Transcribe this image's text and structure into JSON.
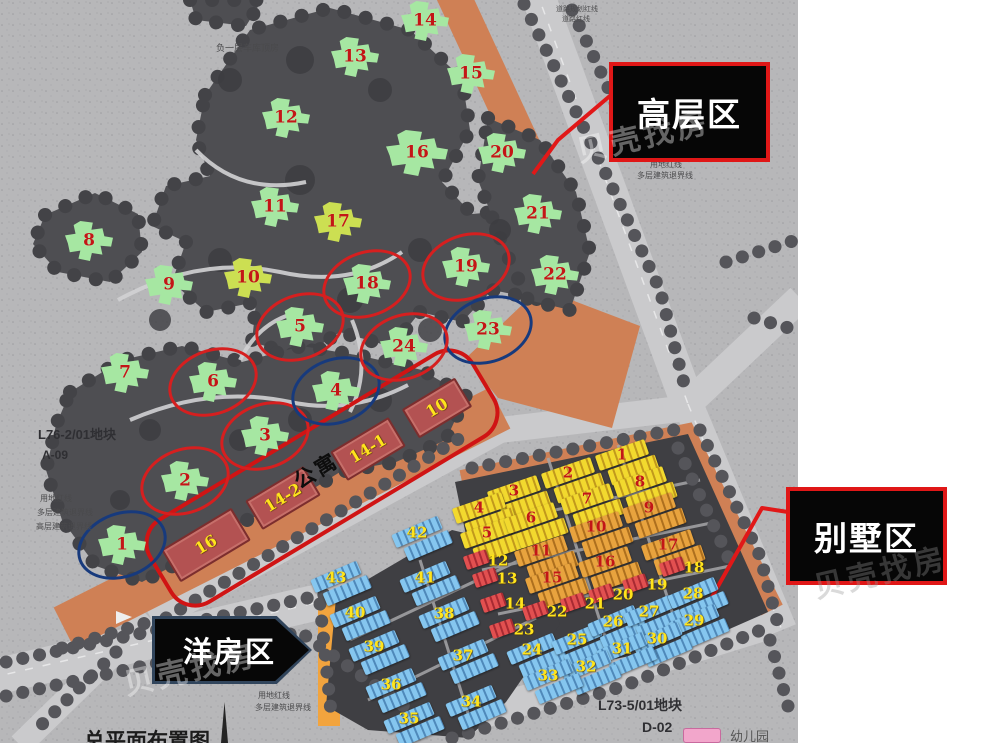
{
  "zones": {
    "highrise_label": "高层区",
    "villa_label": "别墅区",
    "garden_label": "洋房区"
  },
  "apartment": {
    "label": "公寓",
    "blocks": [
      {
        "label": "16",
        "x": 206,
        "y": 545,
        "w": 78,
        "h": 34
      },
      {
        "label": "14-2",
        "x": 283,
        "y": 498,
        "w": 64,
        "h": 30
      },
      {
        "label": "14-1",
        "x": 368,
        "y": 449,
        "w": 64,
        "h": 30
      },
      {
        "label": "10",
        "x": 437,
        "y": 408,
        "w": 58,
        "h": 30
      }
    ]
  },
  "highrise_buildings": [
    {
      "n": "1",
      "x": 122,
      "y": 545,
      "kind": "green",
      "ring": "blue"
    },
    {
      "n": "2",
      "x": 185,
      "y": 481,
      "kind": "green",
      "ring": "red"
    },
    {
      "n": "3",
      "x": 265,
      "y": 436,
      "kind": "green",
      "ring": "red"
    },
    {
      "n": "4",
      "x": 336,
      "y": 391,
      "kind": "green",
      "ring": "blue"
    },
    {
      "n": "5",
      "x": 300,
      "y": 327,
      "kind": "green",
      "ring": "red"
    },
    {
      "n": "6",
      "x": 213,
      "y": 382,
      "kind": "green",
      "ring": "red"
    },
    {
      "n": "7",
      "x": 125,
      "y": 373,
      "kind": "green",
      "ring": null
    },
    {
      "n": "8",
      "x": 89,
      "y": 241,
      "kind": "green",
      "ring": null
    },
    {
      "n": "9",
      "x": 169,
      "y": 285,
      "kind": "green",
      "ring": null
    },
    {
      "n": "10",
      "x": 248,
      "y": 278,
      "kind": "lime",
      "ring": null
    },
    {
      "n": "11",
      "x": 275,
      "y": 207,
      "kind": "green",
      "ring": null
    },
    {
      "n": "12",
      "x": 286,
      "y": 118,
      "kind": "green",
      "ring": null
    },
    {
      "n": "13",
      "x": 355,
      "y": 57,
      "kind": "green",
      "ring": null
    },
    {
      "n": "14",
      "x": 425,
      "y": 21,
      "kind": "green",
      "ring": null
    },
    {
      "n": "15",
      "x": 471,
      "y": 74,
      "kind": "green",
      "ring": null
    },
    {
      "n": "16",
      "x": 417,
      "y": 153,
      "kind": "green",
      "ring": null,
      "big": true
    },
    {
      "n": "17",
      "x": 338,
      "y": 222,
      "kind": "lime",
      "ring": null
    },
    {
      "n": "18",
      "x": 367,
      "y": 284,
      "kind": "green",
      "ring": "red"
    },
    {
      "n": "19",
      "x": 466,
      "y": 267,
      "kind": "green",
      "ring": "red"
    },
    {
      "n": "20",
      "x": 502,
      "y": 153,
      "kind": "green",
      "ring": null
    },
    {
      "n": "21",
      "x": 538,
      "y": 214,
      "kind": "green",
      "ring": null
    },
    {
      "n": "22",
      "x": 555,
      "y": 275,
      "kind": "green",
      "ring": null
    },
    {
      "n": "23",
      "x": 488,
      "y": 330,
      "kind": "green",
      "ring": "blue"
    },
    {
      "n": "24",
      "x": 404,
      "y": 347,
      "kind": "green",
      "ring": "red"
    }
  ],
  "villa_buildings": [
    {
      "n": "1",
      "x": 622,
      "y": 455,
      "kind": "yellow"
    },
    {
      "n": "2",
      "x": 568,
      "y": 473,
      "kind": "yellow"
    },
    {
      "n": "3",
      "x": 514,
      "y": 491,
      "kind": "yellow"
    },
    {
      "n": "4",
      "x": 479,
      "y": 508,
      "kind": "yellow"
    },
    {
      "n": "5",
      "x": 487,
      "y": 533,
      "kind": "yellow"
    },
    {
      "n": "6",
      "x": 531,
      "y": 518,
      "kind": "yellow"
    },
    {
      "n": "7",
      "x": 587,
      "y": 499,
      "kind": "yellow"
    },
    {
      "n": "8",
      "x": 640,
      "y": 482,
      "kind": "yellow"
    },
    {
      "n": "9",
      "x": 649,
      "y": 508,
      "kind": "orange"
    },
    {
      "n": "10",
      "x": 596,
      "y": 527,
      "kind": "orange"
    },
    {
      "n": "11",
      "x": 541,
      "y": 551,
      "kind": "orange"
    },
    {
      "n": "15",
      "x": 552,
      "y": 578,
      "kind": "orange"
    },
    {
      "n": "16",
      "x": 605,
      "y": 562,
      "kind": "orange"
    },
    {
      "n": "17",
      "x": 668,
      "y": 545,
      "kind": "orange"
    },
    {
      "n": "12",
      "x": 498,
      "y": 561,
      "kind": "redsm"
    },
    {
      "n": "13",
      "x": 507,
      "y": 579,
      "kind": "redsm"
    },
    {
      "n": "14",
      "x": 515,
      "y": 604,
      "kind": "redsm"
    },
    {
      "n": "18",
      "x": 694,
      "y": 568,
      "kind": "redsm"
    },
    {
      "n": "19",
      "x": 657,
      "y": 585,
      "kind": "redsm"
    },
    {
      "n": "20",
      "x": 623,
      "y": 595,
      "kind": "redsm"
    },
    {
      "n": "21",
      "x": 595,
      "y": 604,
      "kind": "redsm"
    },
    {
      "n": "22",
      "x": 557,
      "y": 612,
      "kind": "redsm"
    },
    {
      "n": "23",
      "x": 524,
      "y": 630,
      "kind": "redsm"
    },
    {
      "n": "24",
      "x": 532,
      "y": 650,
      "kind": "blue"
    },
    {
      "n": "25",
      "x": 577,
      "y": 640,
      "kind": "blue"
    },
    {
      "n": "26",
      "x": 613,
      "y": 622,
      "kind": "blue"
    },
    {
      "n": "27",
      "x": 649,
      "y": 612,
      "kind": "blue"
    },
    {
      "n": "28",
      "x": 693,
      "y": 594,
      "kind": "blue"
    },
    {
      "n": "29",
      "x": 694,
      "y": 621,
      "kind": "blue"
    },
    {
      "n": "30",
      "x": 657,
      "y": 639,
      "kind": "blue"
    },
    {
      "n": "31",
      "x": 622,
      "y": 649,
      "kind": "blue"
    },
    {
      "n": "32",
      "x": 586,
      "y": 667,
      "kind": "blue"
    },
    {
      "n": "33",
      "x": 548,
      "y": 676,
      "kind": "blue"
    },
    {
      "n": "34",
      "x": 471,
      "y": 702,
      "kind": "blue"
    },
    {
      "n": "35",
      "x": 409,
      "y": 719,
      "kind": "blue"
    },
    {
      "n": "36",
      "x": 391,
      "y": 685,
      "kind": "blue"
    },
    {
      "n": "37",
      "x": 463,
      "y": 656,
      "kind": "blue"
    },
    {
      "n": "38",
      "x": 444,
      "y": 614,
      "kind": "blue"
    },
    {
      "n": "39",
      "x": 374,
      "y": 647,
      "kind": "blue"
    },
    {
      "n": "40",
      "x": 355,
      "y": 613,
      "kind": "blue"
    },
    {
      "n": "41",
      "x": 425,
      "y": 578,
      "kind": "blue"
    },
    {
      "n": "42",
      "x": 417,
      "y": 533,
      "kind": "blue"
    },
    {
      "n": "43",
      "x": 336,
      "y": 578,
      "kind": "blue"
    }
  ],
  "map_texts": [
    {
      "text": "负一层车库顶房",
      "x": 216,
      "y": 44,
      "size": 9
    },
    {
      "text": "道路规划红线",
      "x": 556,
      "y": 6,
      "size": 7
    },
    {
      "text": "道路红线",
      "x": 562,
      "y": 16,
      "size": 7
    },
    {
      "text": "用地红线",
      "x": 650,
      "y": 161,
      "size": 8
    },
    {
      "text": "多层建筑退界线",
      "x": 637,
      "y": 172,
      "size": 8
    },
    {
      "text": "L76-2/01地块",
      "x": 38,
      "y": 428,
      "size": 13,
      "bold": true,
      "color": "#2f2f33"
    },
    {
      "text": "A-09",
      "x": 42,
      "y": 449,
      "size": 12,
      "bold": true,
      "color": "#2f2f33"
    },
    {
      "text": "用地红线",
      "x": 40,
      "y": 495,
      "size": 8
    },
    {
      "text": "多层建筑退界线",
      "x": 37,
      "y": 509,
      "size": 8
    },
    {
      "text": "高层建筑退界线",
      "x": 36,
      "y": 523,
      "size": 8
    },
    {
      "text": "用地红线",
      "x": 258,
      "y": 692,
      "size": 8
    },
    {
      "text": "多层建筑退界线",
      "x": 255,
      "y": 704,
      "size": 8
    },
    {
      "text": "L73-5/01地块",
      "x": 598,
      "y": 698,
      "size": 14,
      "bold": true,
      "color": "#2f2f33"
    },
    {
      "text": "D-02",
      "x": 642,
      "y": 720,
      "size": 14,
      "bold": true,
      "color": "#2f2f33"
    },
    {
      "text": "总平面布置图",
      "x": 84,
      "y": 730,
      "size": 21,
      "bold": true,
      "color": "#1c1c1c"
    }
  ],
  "legend": {
    "items": [
      {
        "label": "幼儿园",
        "color": "#f2a6cb"
      }
    ]
  },
  "watermark": {
    "text": "贝壳找房",
    "instances": [
      {
        "x": 575,
        "y": 112,
        "on_dark": true
      },
      {
        "x": 122,
        "y": 645,
        "on_dark": true
      },
      {
        "x": 812,
        "y": 548,
        "on_dark": false
      }
    ]
  },
  "colors": {
    "ring_red": "#d61f1f",
    "ring_blue": "#173a7d",
    "highrise_green": "#a6e7a2",
    "highrise_lime": "#ccdf52",
    "villa_yellow_a": "#f2d92e",
    "villa_yellow_b": "#c1991c",
    "villa_orange_a": "#e8a33e",
    "villa_orange_b": "#ad6f1e",
    "villa_red_a": "#e25050",
    "villa_red_b": "#a82a32",
    "garden_blue_a": "#85c6ef",
    "garden_blue_b": "#4f89ba",
    "apartment_red": "#b35252",
    "orange_band": "#cf8055",
    "legend_pink": "#f2a6cb"
  }
}
